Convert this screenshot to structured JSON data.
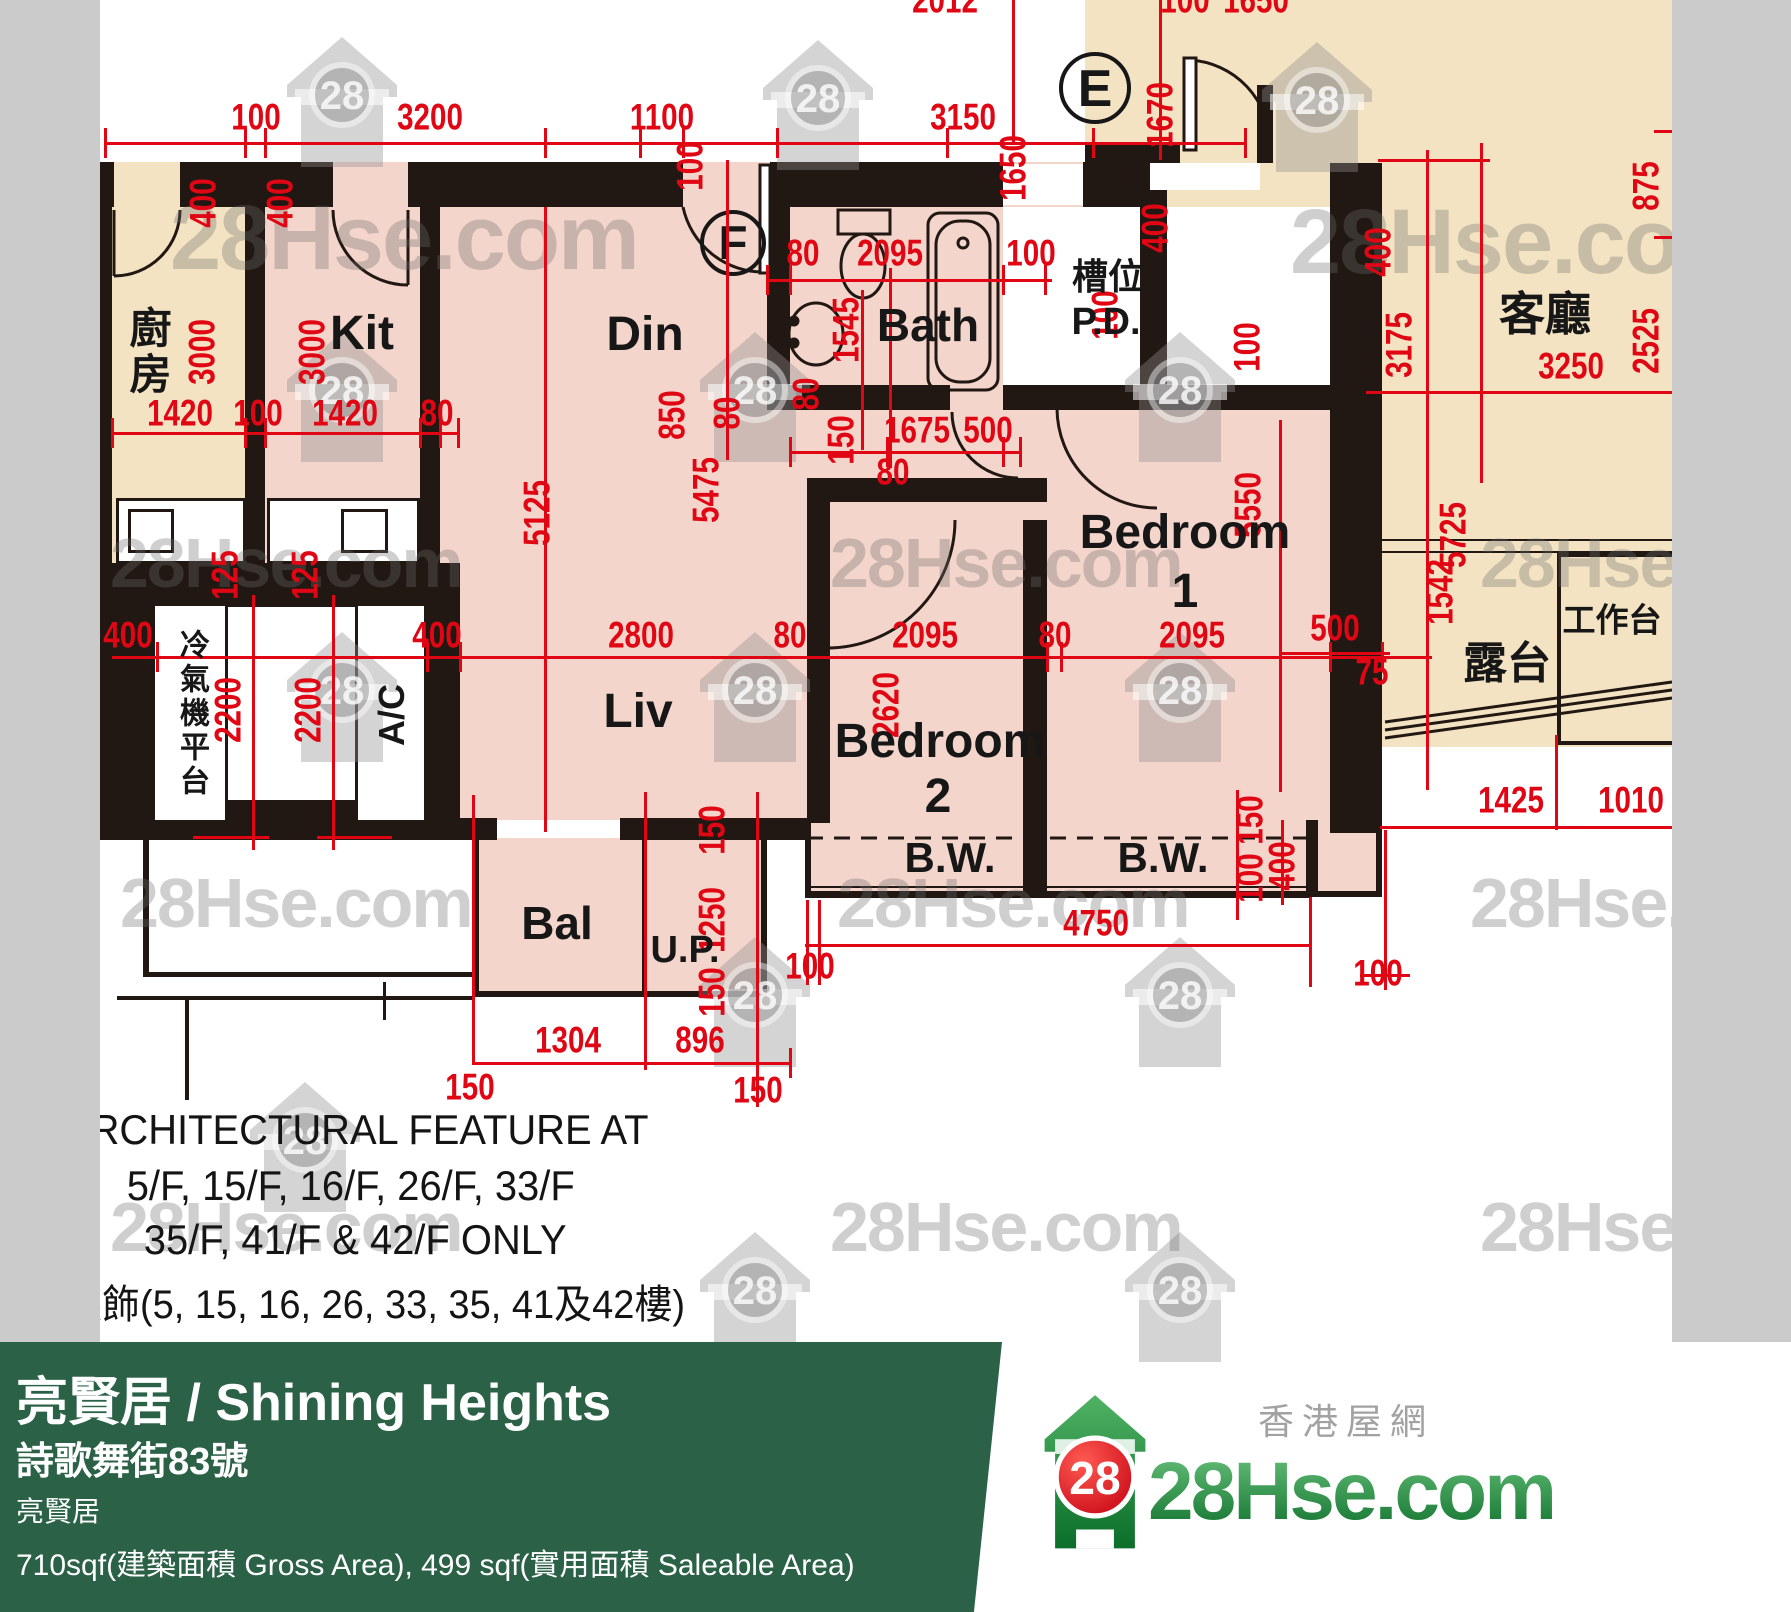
{
  "colors": {
    "beige": "#f3e3c2",
    "pink": "#f4d5cb",
    "wall": "#221813",
    "dim_red": "#e00613",
    "gray_strip": "#cbcbcb",
    "footer_green": "#2b6247",
    "brand_green": "#0b6e2a",
    "badge_red": "#d6000f"
  },
  "watermark": {
    "text": "28Hse.com",
    "badge": "28"
  },
  "plan": {
    "fills": [
      [
        100,
        162,
        165,
        445,
        "beige"
      ],
      [
        265,
        162,
        545,
        678,
        "pink"
      ],
      [
        777,
        162,
        553,
        250,
        "pink"
      ],
      [
        807,
        410,
        575,
        487,
        "pink"
      ],
      [
        473,
        815,
        294,
        182,
        "pink"
      ],
      [
        1085,
        0,
        587,
        392,
        "beige"
      ],
      [
        1382,
        392,
        290,
        355,
        "beige"
      ],
      [
        1003,
        207,
        137,
        195,
        "white"
      ],
      [
        1167,
        207,
        163,
        185,
        "white"
      ],
      [
        228,
        607,
        129,
        195,
        "white"
      ]
    ],
    "walls": [
      [
        100,
        162,
        14,
        45
      ],
      [
        180,
        162,
        153,
        45
      ],
      [
        408,
        162,
        275,
        45
      ],
      [
        770,
        162,
        233,
        45
      ],
      [
        1083,
        162,
        57,
        45
      ],
      [
        100,
        162,
        12,
        445
      ],
      [
        245,
        162,
        20,
        445
      ],
      [
        420,
        207,
        20,
        400
      ],
      [
        767,
        207,
        23,
        203
      ],
      [
        767,
        385,
        183,
        25
      ],
      [
        1003,
        385,
        327,
        25
      ],
      [
        1140,
        160,
        27,
        242
      ],
      [
        807,
        478,
        240,
        24
      ],
      [
        807,
        500,
        23,
        323
      ],
      [
        1023,
        520,
        24,
        303
      ],
      [
        1330,
        163,
        52,
        670
      ],
      [
        100,
        563,
        360,
        44
      ],
      [
        100,
        607,
        57,
        233
      ],
      [
        427,
        607,
        33,
        233
      ],
      [
        157,
        800,
        270,
        40
      ],
      [
        427,
        818,
        70,
        22
      ],
      [
        620,
        818,
        187,
        22
      ],
      [
        1085,
        145,
        95,
        18
      ],
      [
        1257,
        85,
        16,
        78
      ],
      [
        805,
        820,
        6,
        77
      ],
      [
        1306,
        820,
        6,
        77
      ],
      [
        805,
        891,
        507,
        7
      ],
      [
        1023,
        823,
        24,
        70
      ],
      [
        1312,
        820,
        6,
        77
      ],
      [
        1376,
        820,
        6,
        77
      ],
      [
        1312,
        891,
        70,
        6
      ],
      [
        473,
        820,
        6,
        177
      ],
      [
        761,
        820,
        6,
        177
      ],
      [
        473,
        991,
        294,
        6
      ],
      [
        642,
        823,
        5,
        170
      ],
      [
        143,
        840,
        6,
        137
      ],
      [
        143,
        972,
        330,
        5
      ],
      [
        117,
        996,
        356,
        4
      ],
      [
        383,
        982,
        3,
        38
      ],
      [
        185,
        996,
        4,
        104
      ],
      [
        1557,
        553,
        4,
        192
      ],
      [
        1557,
        553,
        115,
        4
      ],
      [
        1557,
        741,
        115,
        4
      ],
      [
        185,
        514,
        53,
        2
      ],
      [
        185,
        529,
        53,
        2
      ],
      [
        185,
        544,
        53,
        2
      ],
      [
        278,
        514,
        52,
        2
      ],
      [
        278,
        529,
        52,
        2
      ],
      [
        278,
        544,
        52,
        2
      ],
      [
        1003,
        171,
        80,
        2
      ],
      [
        1003,
        182,
        80,
        2
      ],
      [
        1003,
        193,
        80,
        2
      ],
      [
        1150,
        170,
        110,
        2
      ],
      [
        1150,
        180,
        110,
        2
      ],
      [
        497,
        824,
        123,
        2
      ],
      [
        497,
        832,
        123,
        2
      ],
      [
        620,
        820,
        80,
        2
      ],
      [
        680,
        828,
        80,
        2
      ],
      [
        1382,
        539,
        290,
        2
      ],
      [
        1382,
        551,
        290,
        2
      ],
      [
        810,
        886,
        498,
        2
      ]
    ],
    "white_boxes": [
      [
        152,
        603,
        76,
        220
      ],
      [
        355,
        603,
        72,
        220
      ],
      [
        116,
        498,
        130,
        66
      ],
      [
        267,
        498,
        153,
        66
      ],
      [
        128,
        509,
        46,
        44
      ],
      [
        341,
        509,
        47,
        44
      ]
    ],
    "white_slots": [
      [
        1003,
        164,
        80,
        41
      ],
      [
        1150,
        163,
        110,
        27
      ],
      [
        497,
        820,
        123,
        18
      ]
    ],
    "red_lines": [
      [
        105,
        142,
        1140,
        3
      ],
      [
        1012,
        0,
        3,
        143
      ],
      [
        1159,
        0,
        3,
        160
      ],
      [
        112,
        432,
        348,
        3
      ],
      [
        767,
        279,
        285,
        3
      ],
      [
        790,
        451,
        230,
        3
      ],
      [
        112,
        656,
        1320,
        3
      ],
      [
        252,
        595,
        3,
        255
      ],
      [
        332,
        595,
        3,
        255
      ],
      [
        193,
        836,
        76,
        3
      ],
      [
        317,
        836,
        75,
        3
      ],
      [
        544,
        207,
        3,
        625
      ],
      [
        726,
        160,
        3,
        300
      ],
      [
        889,
        268,
        3,
        200
      ],
      [
        861,
        290,
        3,
        160
      ],
      [
        1279,
        420,
        3,
        372
      ],
      [
        805,
        944,
        507,
        3
      ],
      [
        806,
        900,
        3,
        85
      ],
      [
        818,
        900,
        3,
        85
      ],
      [
        1309,
        897,
        3,
        90
      ],
      [
        473,
        1062,
        318,
        3
      ],
      [
        472,
        795,
        3,
        270
      ],
      [
        644,
        792,
        3,
        278
      ],
      [
        756,
        792,
        3,
        315
      ],
      [
        789,
        1048,
        3,
        30
      ],
      [
        1426,
        150,
        3,
        640
      ],
      [
        1480,
        143,
        3,
        340
      ],
      [
        1366,
        391,
        306,
        3
      ],
      [
        1378,
        159,
        112,
        3
      ],
      [
        1380,
        826,
        292,
        3
      ],
      [
        1384,
        830,
        3,
        160
      ],
      [
        1555,
        735,
        3,
        95
      ],
      [
        1360,
        974,
        50,
        3
      ],
      [
        1280,
        652,
        110,
        3
      ],
      [
        1236,
        790,
        3,
        130
      ],
      [
        1281,
        820,
        3,
        85
      ],
      [
        1654,
        130,
        18,
        3
      ],
      [
        1654,
        236,
        18,
        3
      ],
      [
        104,
        128,
        3,
        30
      ],
      [
        244,
        128,
        3,
        30
      ],
      [
        264,
        128,
        3,
        30
      ],
      [
        544,
        128,
        3,
        30
      ],
      [
        639,
        128,
        3,
        30
      ],
      [
        682,
        128,
        3,
        30
      ],
      [
        776,
        128,
        3,
        30
      ],
      [
        946,
        128,
        3,
        30
      ],
      [
        1092,
        128,
        3,
        30
      ],
      [
        1244,
        128,
        3,
        30
      ],
      [
        111,
        418,
        3,
        30
      ],
      [
        244,
        418,
        3,
        30
      ],
      [
        264,
        418,
        3,
        30
      ],
      [
        419,
        418,
        3,
        30
      ],
      [
        439,
        418,
        3,
        30
      ],
      [
        457,
        418,
        3,
        30
      ],
      [
        766,
        265,
        3,
        30
      ],
      [
        789,
        265,
        3,
        30
      ],
      [
        1002,
        265,
        3,
        30
      ],
      [
        1044,
        265,
        3,
        30
      ],
      [
        789,
        437,
        3,
        30
      ],
      [
        886,
        437,
        3,
        30
      ],
      [
        1002,
        437,
        3,
        30
      ],
      [
        1019,
        437,
        3,
        30
      ],
      [
        156,
        642,
        3,
        30
      ],
      [
        426,
        642,
        3,
        30
      ],
      [
        459,
        642,
        3,
        30
      ],
      [
        1046,
        642,
        3,
        30
      ],
      [
        1060,
        642,
        3,
        30
      ],
      [
        1329,
        642,
        3,
        30
      ],
      [
        1381,
        642,
        3,
        30
      ]
    ],
    "dim_labels": [
      [
        "100",
        256,
        117,
        0
      ],
      [
        "3200",
        430,
        117,
        0
      ],
      [
        "1100",
        662,
        117,
        0
      ],
      [
        "3150",
        963,
        117,
        0
      ],
      [
        "2012",
        945,
        0,
        0
      ],
      [
        "100",
        1185,
        0,
        0
      ],
      [
        "1650",
        1256,
        0,
        0
      ],
      [
        "1420",
        180,
        413,
        0
      ],
      [
        "100",
        258,
        413,
        0
      ],
      [
        "1420",
        345,
        413,
        0
      ],
      [
        "80",
        437,
        413,
        0
      ],
      [
        "80",
        803,
        253,
        0
      ],
      [
        "2095",
        890,
        253,
        0
      ],
      [
        "100",
        1031,
        253,
        0
      ],
      [
        "1675",
        917,
        430,
        0
      ],
      [
        "500",
        988,
        430,
        0
      ],
      [
        "80",
        893,
        472,
        0
      ],
      [
        "400",
        128,
        635,
        0
      ],
      [
        "400",
        437,
        635,
        0
      ],
      [
        "2800",
        641,
        635,
        0
      ],
      [
        "80",
        790,
        635,
        0
      ],
      [
        "2095",
        925,
        635,
        0
      ],
      [
        "80",
        1055,
        635,
        0
      ],
      [
        "2095",
        1192,
        635,
        0
      ],
      [
        "500",
        1335,
        628,
        0
      ],
      [
        "75",
        1372,
        672,
        0
      ],
      [
        "1304",
        568,
        1040,
        0
      ],
      [
        "896",
        700,
        1040,
        0
      ],
      [
        "150",
        470,
        1087,
        0
      ],
      [
        "150",
        758,
        1090,
        0
      ],
      [
        "100",
        810,
        966,
        0
      ],
      [
        "4750",
        1096,
        923,
        0
      ],
      [
        "100",
        1378,
        973,
        0
      ],
      [
        "100",
        1700,
        815,
        0
      ],
      [
        "1425",
        1511,
        800,
        0
      ],
      [
        "1010",
        1631,
        800,
        0
      ],
      [
        "3250",
        1571,
        366,
        0
      ],
      [
        "1650",
        1013,
        168,
        1
      ],
      [
        "1670",
        1160,
        115,
        1
      ],
      [
        "400",
        1155,
        228,
        1
      ],
      [
        "875",
        1646,
        186,
        1
      ],
      [
        "2525",
        1646,
        341,
        1
      ],
      [
        "3175",
        1399,
        345,
        1
      ],
      [
        "5725",
        1453,
        535,
        1
      ],
      [
        "1542",
        1440,
        592,
        1
      ],
      [
        "400",
        203,
        203,
        1
      ],
      [
        "400",
        280,
        203,
        1
      ],
      [
        "3000",
        202,
        352,
        1
      ],
      [
        "3000",
        312,
        352,
        1
      ],
      [
        "5125",
        537,
        513,
        1
      ],
      [
        "5475",
        706,
        490,
        1
      ],
      [
        "100",
        690,
        166,
        1
      ],
      [
        "1545",
        846,
        330,
        1
      ],
      [
        "80",
        806,
        394,
        1
      ],
      [
        "80",
        727,
        413,
        1
      ],
      [
        "850",
        672,
        415,
        1
      ],
      [
        "150",
        841,
        440,
        1
      ],
      [
        "100",
        1105,
        315,
        1
      ],
      [
        "100",
        1247,
        347,
        1
      ],
      [
        "400",
        1378,
        252,
        1
      ],
      [
        "5550",
        1248,
        505,
        1
      ],
      [
        "2620",
        886,
        705,
        1
      ],
      [
        "125",
        225,
        575,
        1
      ],
      [
        "2200",
        228,
        710,
        1
      ],
      [
        "125",
        305,
        575,
        1
      ],
      [
        "2200",
        308,
        710,
        1
      ],
      [
        "150",
        712,
        830,
        1
      ],
      [
        "1250",
        712,
        920,
        1
      ],
      [
        "150",
        712,
        992,
        1
      ],
      [
        "150",
        1250,
        820,
        1
      ],
      [
        "100",
        1250,
        878,
        1
      ],
      [
        "400",
        1282,
        866,
        1
      ]
    ],
    "room_labels": [
      [
        "Kit",
        362,
        334,
        48,
        ""
      ],
      [
        "Din",
        645,
        335,
        48,
        ""
      ],
      [
        "Liv",
        638,
        712,
        48,
        ""
      ],
      [
        "Bath",
        928,
        325,
        46,
        ""
      ],
      [
        "Bedroom",
        1185,
        533,
        48,
        ""
      ],
      [
        "1",
        1185,
        592,
        48,
        ""
      ],
      [
        "Bedroom",
        940,
        742,
        48,
        ""
      ],
      [
        "2",
        938,
        797,
        48,
        ""
      ],
      [
        "B.W.",
        950,
        858,
        42,
        ""
      ],
      [
        "B.W.",
        1163,
        858,
        42,
        ""
      ],
      [
        "Bal",
        557,
        923,
        46,
        ""
      ],
      [
        "U.P.",
        685,
        950,
        38,
        ""
      ],
      [
        "客廳",
        1545,
        314,
        46,
        ""
      ],
      [
        "露台",
        1507,
        664,
        44,
        ""
      ],
      [
        "工作台",
        1612,
        620,
        33,
        ""
      ],
      [
        "槽位",
        1108,
        277,
        36,
        ""
      ],
      [
        "P.D.",
        1106,
        322,
        38,
        ""
      ],
      [
        "廚房",
        147,
        352,
        42,
        "cjkv"
      ],
      [
        "冷氣機平台",
        191,
        714,
        30,
        "cjkv"
      ],
      [
        "A/C",
        392,
        715,
        36,
        "rot"
      ]
    ],
    "markers": [
      [
        "E",
        1095,
        88,
        72
      ],
      [
        "F",
        733,
        243,
        66
      ]
    ],
    "annotation": [
      "ARCHITECTURAL FEATURE AT",
      "5/F, 15/F, 16/F, 26/F, 33/F",
      "35/F, 41/F & 42/F ONLY",
      "裝飾(5, 15, 16, 26, 33, 35, 41及42樓)"
    ],
    "houses": [
      [
        342,
        95
      ],
      [
        818,
        98
      ],
      [
        1317,
        100
      ],
      [
        342,
        390
      ],
      [
        755,
        390
      ],
      [
        1180,
        390
      ],
      [
        342,
        690
      ],
      [
        755,
        690
      ],
      [
        1180,
        690
      ],
      [
        755,
        995
      ],
      [
        1180,
        995
      ],
      [
        305,
        1140
      ],
      [
        755,
        1290
      ],
      [
        1180,
        1290
      ]
    ],
    "wm_texts": [
      [
        170,
        192,
        92
      ],
      [
        1290,
        196,
        92
      ],
      [
        110,
        528,
        70
      ],
      [
        830,
        528,
        70
      ],
      [
        1480,
        528,
        70
      ],
      [
        120,
        868,
        70
      ],
      [
        837,
        868,
        70
      ],
      [
        1470,
        868,
        70
      ],
      [
        110,
        1192,
        70
      ],
      [
        830,
        1192,
        70
      ],
      [
        1480,
        1192,
        70
      ]
    ]
  },
  "footer": {
    "title": "亮賢居 / Shining Heights",
    "address": "詩歌舞街83號",
    "estate": "亮賢居",
    "area": "710sqf(建築面積 Gross Area), 499 sqf(實用面積 Saleable Area)",
    "brand": {
      "name": "28Hse.com",
      "tagline": "香港屋網",
      "badge": "28"
    }
  }
}
